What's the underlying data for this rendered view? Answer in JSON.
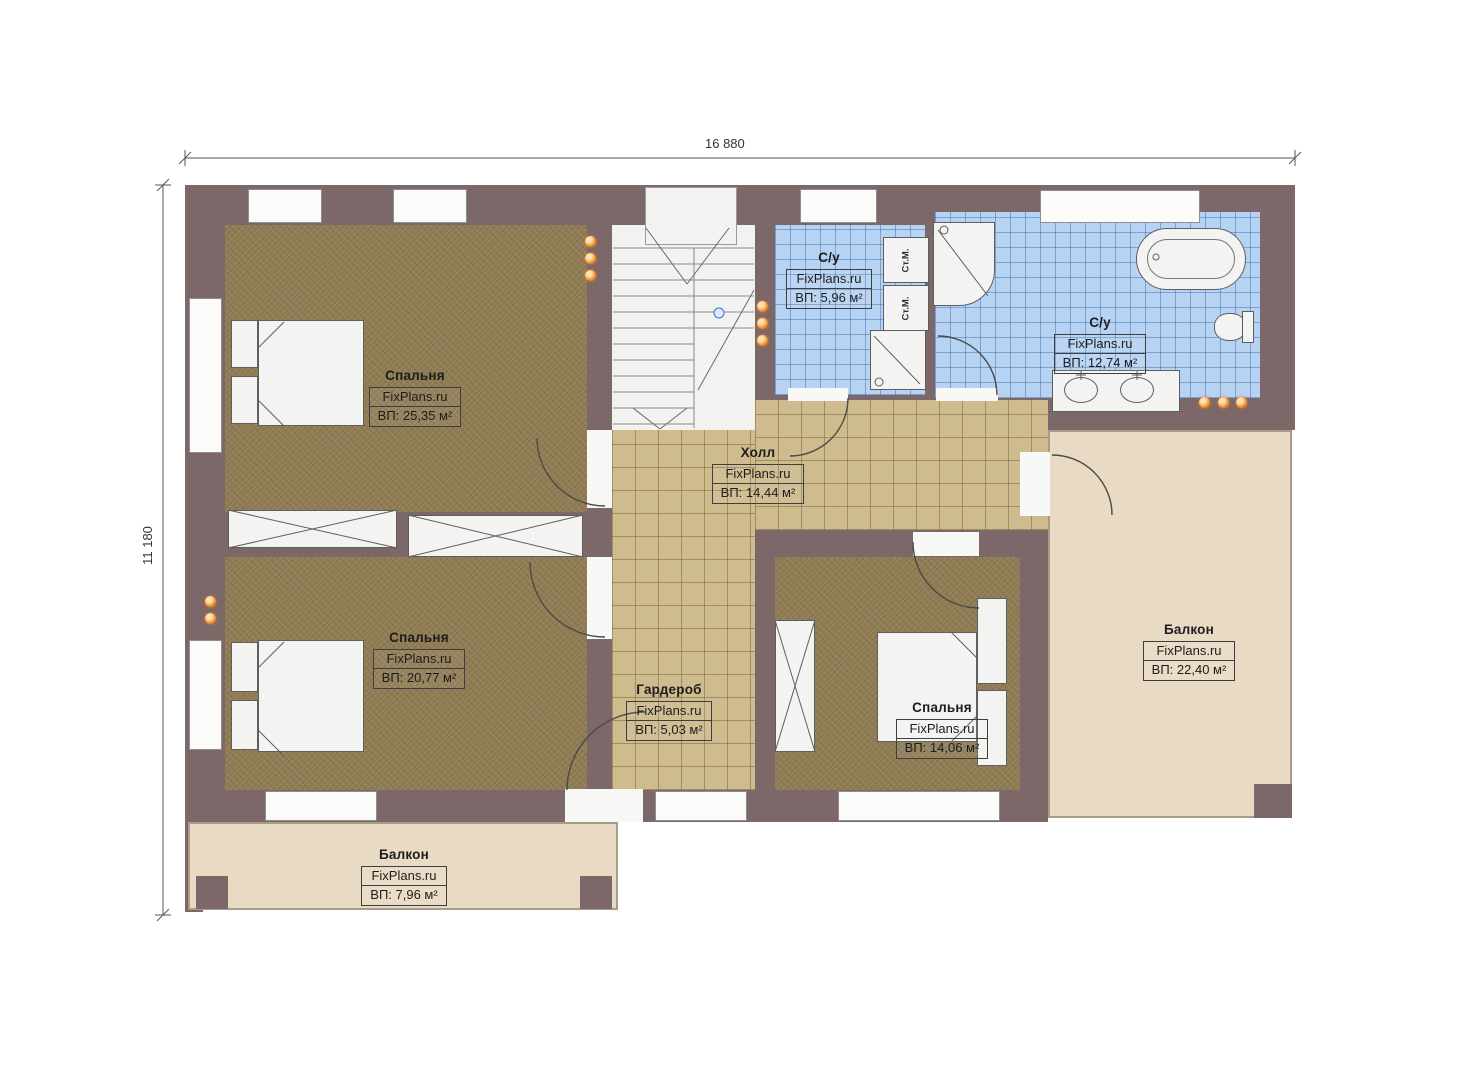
{
  "dimensions": {
    "width": "16 880",
    "height": "11 180"
  },
  "watermark": "FixPlans.ru",
  "rooms": [
    {
      "id": "bedroom-1",
      "name": "Спальня",
      "watermark": "FixPlans.ru",
      "area": "ВП: 25,35 м²"
    },
    {
      "id": "bedroom-2",
      "name": "Спальня",
      "watermark": "FixPlans.ru",
      "area": "ВП: 20,77 м²"
    },
    {
      "id": "bedroom-3",
      "name": "Спальня",
      "watermark": "FixPlans.ru",
      "area": "ВП: 14,06 м²"
    },
    {
      "id": "hall",
      "name": "Холл",
      "watermark": "FixPlans.ru",
      "area": "ВП: 14,44 м²"
    },
    {
      "id": "wardrobe",
      "name": "Гардероб",
      "watermark": "FixPlans.ru",
      "area": "ВП: 5,03 м²"
    },
    {
      "id": "bathroom-small",
      "name": "С/у",
      "watermark": "FixPlans.ru",
      "area": "ВП: 5,96 м²"
    },
    {
      "id": "bathroom-large",
      "name": "С/у",
      "watermark": "FixPlans.ru",
      "area": "ВП: 12,74 м²"
    },
    {
      "id": "balcony-right",
      "name": "Балкон",
      "watermark": "FixPlans.ru",
      "area": "ВП: 22,40 м²"
    },
    {
      "id": "balcony-bottom",
      "name": "Балкон",
      "watermark": "FixPlans.ru",
      "area": "ВП: 7,96 м²"
    }
  ],
  "appliances": {
    "washer_label": "Ст.М."
  },
  "colors": {
    "wall": "#7c6868",
    "bedroom_floor": "#8f7c55",
    "hall_tile": "#cebc8f",
    "bath_tile": "#b7d3f3",
    "balcony_floor": "#e9dac3",
    "outlet_orange": "#ef8a22"
  }
}
